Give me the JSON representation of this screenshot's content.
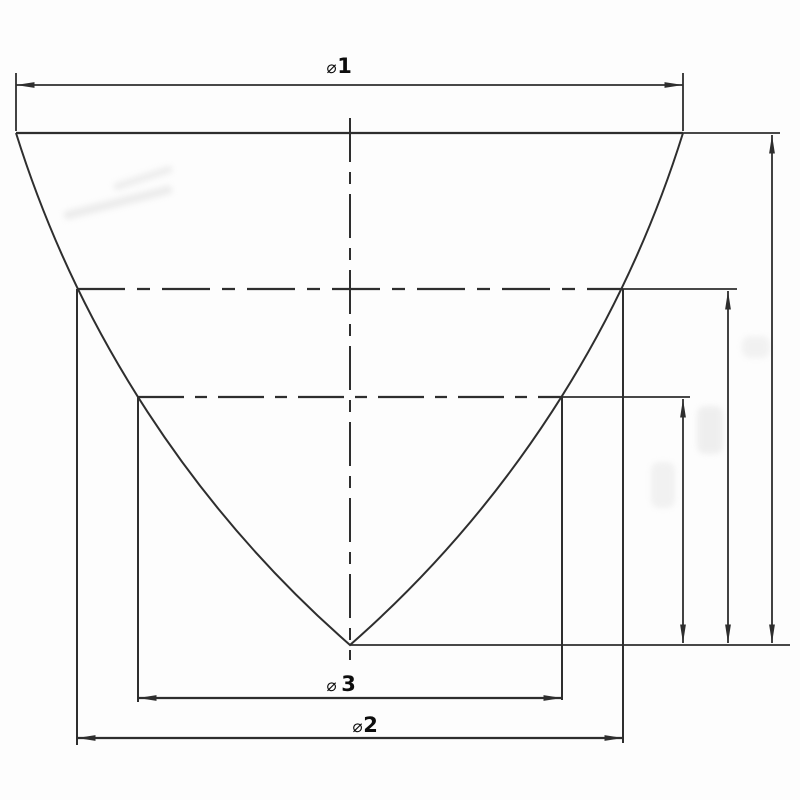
{
  "canvas": {
    "width": 800,
    "height": 800,
    "background_color": "#fdfdfd"
  },
  "colors": {
    "line": "#2e2e2e",
    "label_text": "#0d0d0d",
    "smudge": "#d8d8d8"
  },
  "drawing": {
    "dimension_labels": {
      "phi1": {
        "symbol": "⌀",
        "value": "1"
      },
      "phi2": {
        "symbol": "⌀",
        "value": "2"
      },
      "phi3": {
        "symbol": "⌀",
        "value": "3"
      }
    }
  }
}
